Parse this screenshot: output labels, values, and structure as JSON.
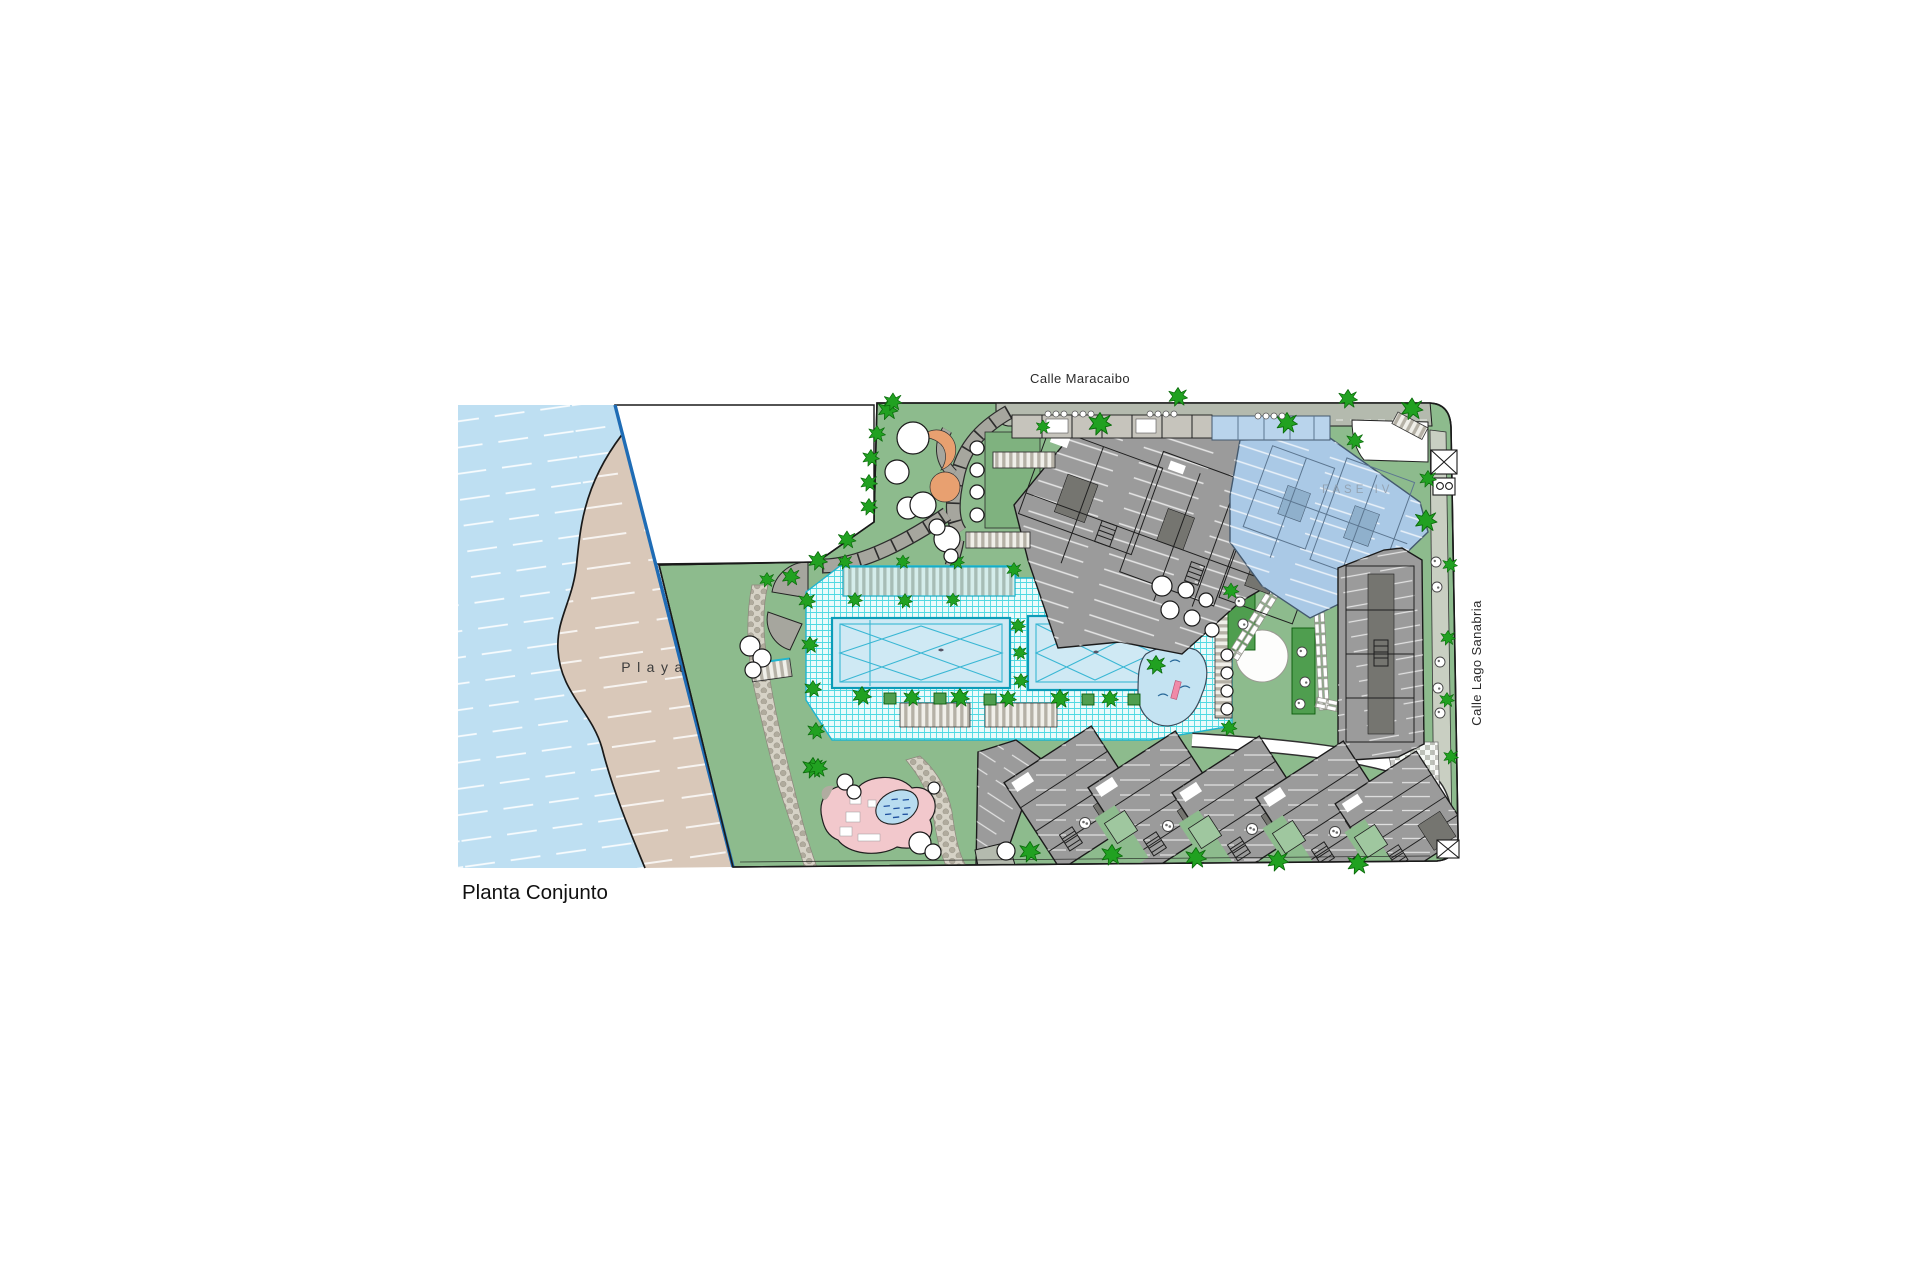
{
  "drawing": {
    "title": "Planta Conjunto"
  },
  "labels": {
    "street_top": "Calle Maracaibo",
    "street_right": "Calle Lago Sanabria",
    "beach": "Playa",
    "phase_label": "FASE IV"
  },
  "colors": {
    "water": "#bedff2",
    "sand": "#d9c8b9",
    "grass": "#8dbb8d",
    "grass2": "#9fc79f",
    "planter": "#4f9e4f",
    "tree": "#21a121",
    "path": "#a6a69e",
    "band": "#b4baae",
    "sidewalk": "#c9cfc2",
    "pool": "#cfe9f4",
    "pooledge": "#0b9cb8",
    "bldg": "#9b9b9b",
    "bldgdark": "#757570",
    "blue": "#aac9e6",
    "blueline": "#44596e",
    "pink": "#f2c8cc",
    "pond": "#b8dcf0",
    "orange": "#e8a070",
    "bound": "#1f6cb5",
    "ink": "#1a1a1a"
  }
}
